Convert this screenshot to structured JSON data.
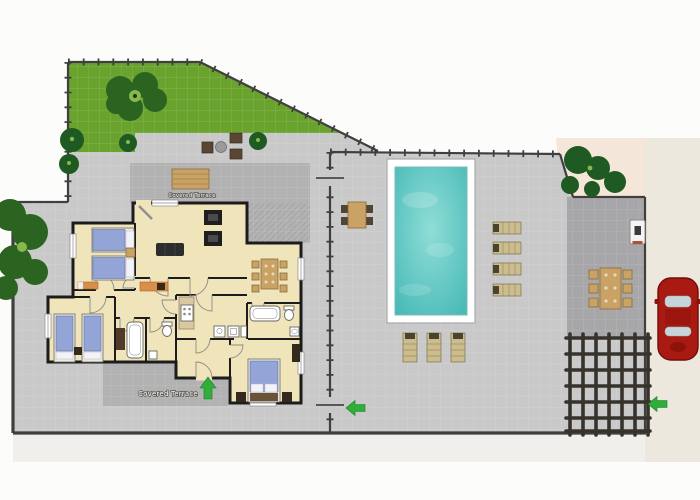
{
  "plan": {
    "labels": {
      "covered_terrace_top": "Covered Terrace",
      "covered_terrace_bottom": "Covered Terrace"
    },
    "areas": [
      "garden",
      "upper-terrace",
      "covered-terrace",
      "house",
      "pool-terrace",
      "driveway",
      "pergola",
      "street-parking",
      "entry-planting"
    ],
    "rooms": [
      "living-room",
      "dining-area",
      "kitchen",
      "bathroom",
      "shower-room",
      "wc",
      "twin-bedroom-north",
      "twin-bedroom-south",
      "master-bedroom",
      "hallway",
      "vestibule"
    ],
    "outdoor_items": [
      "large-tree",
      "shrubs",
      "garden-bench",
      "patio-seating-group",
      "pool-dining-table",
      "swimming-pool",
      "sun-loungers",
      "driveway-dining-table",
      "utility-box",
      "pergola-grid",
      "red-car",
      "gate-arrows"
    ]
  },
  "colors": {
    "page_bg": "#fcfcfa",
    "grass": "#69a32e",
    "tree": "#2b6320",
    "bush": "#1e5a22",
    "terrace": "#c9c9ca",
    "covered": "#b2b2b3",
    "driveway": "#a7a7a9",
    "road": "#ece8dd",
    "entry": "#f4e7da",
    "floor": "#f0e4ba",
    "wall": "#1c1c1c",
    "fence": "#3f3f3f",
    "pool_deep": "#45b9b6",
    "pool_light": "#90ddd7",
    "wood": "#c9a365",
    "wood_dark": "#8a6b35",
    "bed": "#93a4d6",
    "pillow": "#f2f2f7",
    "dark_furniture": "#33291d",
    "sofa": "#2c2c2c",
    "lounger": "#cbbd90",
    "lounger_dark": "#4a442e",
    "arrow": "#2fae3a",
    "car": "#a81a12",
    "car_dark": "#700d07",
    "glass": "#c6d5da",
    "orange": "#d98e4a",
    "pergola": "#38322c",
    "label_fill": "#ffffff",
    "label_stroke": "#5a574f"
  }
}
